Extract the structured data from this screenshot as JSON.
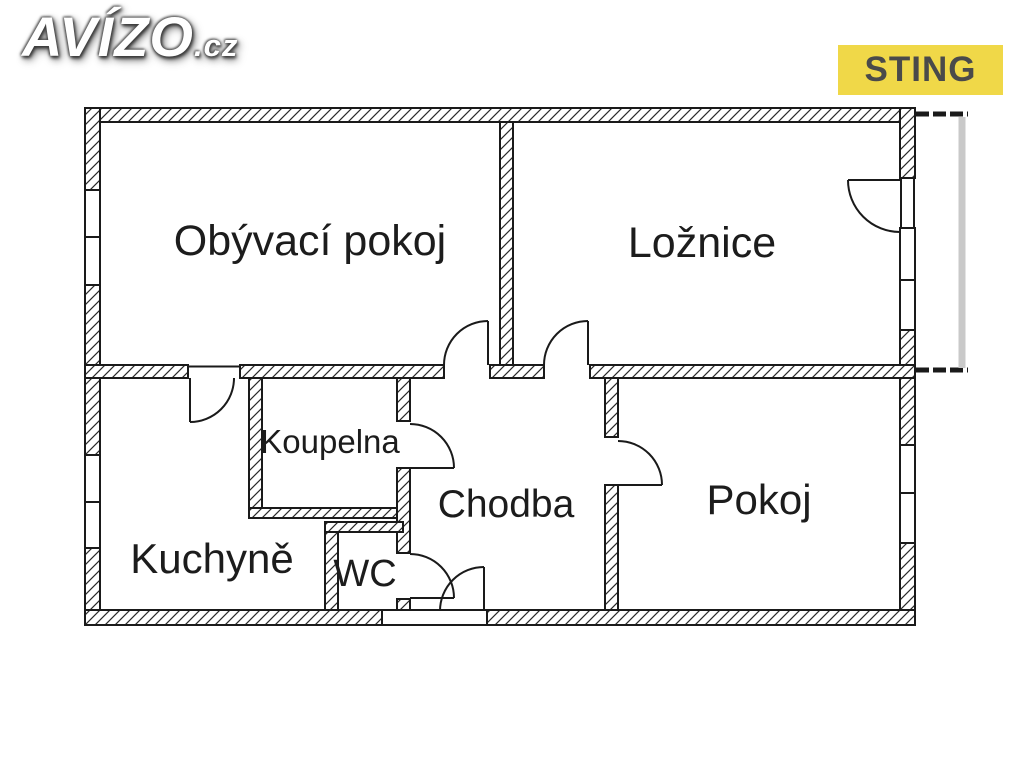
{
  "watermark": {
    "brand": "AVÍZO",
    "tld": ".cz"
  },
  "badge": {
    "label": "STING",
    "bg_color": "#F0D848",
    "text_color": "#4A4A4A"
  },
  "rooms": {
    "living_room": "Obývací pokoj",
    "bedroom": "Ložnice",
    "bathroom": "Koupelna",
    "hallway": "Chodba",
    "kitchen": "Kuchyně",
    "wc": "WC",
    "room": "Pokoj"
  },
  "colors": {
    "background": "#FFFFFF",
    "wall_line": "#1A1A1A",
    "balcony_rail": "#C9C9C9"
  }
}
